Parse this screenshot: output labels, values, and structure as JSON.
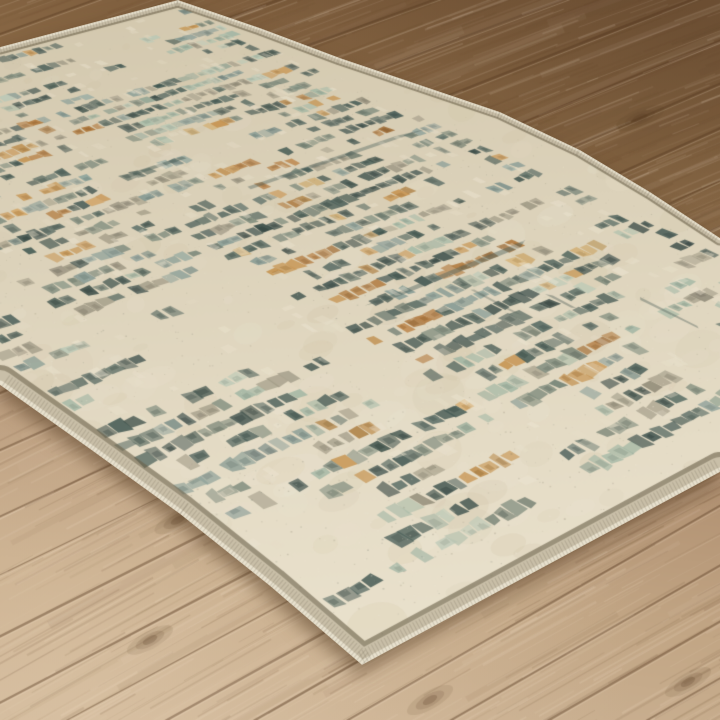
{
  "scene": {
    "subject": "Beige multicolor abstract area rug with dark slate, sage green and amber dashed plaid pattern, displayed at an angle on a brown wood plank floor",
    "width": 720,
    "height": 720
  },
  "floor": {
    "gradient": [
      "#7a5a3b",
      "#8d6c48",
      "#9f7e59",
      "#b19172",
      "#c2a685",
      "#cdb496"
    ],
    "seam_color": "rgba(86,58,34,0.42)",
    "seam_highlight": "rgba(255,240,220,0.20)",
    "plank_spacing": 58,
    "grain_light": "#ffeeda",
    "grain_dark": "#5e4026",
    "knot_color": "rgba(82,56,34,",
    "knots": [
      [
        150,
        640
      ],
      [
        430,
        700
      ],
      [
        688,
        682
      ],
      [
        640,
        118
      ],
      [
        72,
        300
      ],
      [
        178,
        520
      ],
      [
        560,
        420
      ]
    ]
  },
  "rug": {
    "polygon": [
      [
        0,
        385
      ],
      [
        0,
        47
      ],
      [
        178,
        0
      ],
      [
        260,
        28
      ],
      [
        340,
        58
      ],
      [
        420,
        85
      ],
      [
        500,
        112
      ],
      [
        580,
        150
      ],
      [
        650,
        192
      ],
      [
        720,
        238
      ],
      [
        720,
        472
      ],
      [
        362,
        665
      ],
      [
        270,
        586
      ],
      [
        180,
        514
      ],
      [
        90,
        449
      ]
    ],
    "near_edge": [
      [
        720,
        472
      ],
      [
        362,
        665
      ],
      [
        270,
        586
      ],
      [
        180,
        514
      ],
      [
        90,
        449
      ],
      [
        0,
        385
      ]
    ],
    "far_edge": [
      [
        0,
        47
      ],
      [
        178,
        0
      ],
      [
        260,
        28
      ],
      [
        340,
        58
      ],
      [
        420,
        85
      ],
      [
        500,
        112
      ],
      [
        580,
        150
      ],
      [
        650,
        192
      ],
      [
        720,
        238
      ]
    ],
    "corners": {
      "left": [
        -326,
        133
      ],
      "top": [
        178,
        0
      ],
      "near": [
        362,
        665
      ],
      "right": [
        939,
        347
      ]
    },
    "base_colors": [
      "#d3c8ae",
      "#dcd2ba",
      "#e5dcc6",
      "#ebe3cf"
    ],
    "cream": "#e6ddc8",
    "palette": {
      "dark_slate": "#3d544f",
      "deep_slate": "#2e4441",
      "gray_green": "#6e7e71",
      "taupe": "#9a9480",
      "sage": "#9eb4a2",
      "pale_sage": "#b6c7b5",
      "steel": "#7e9590",
      "amber": "#c2893f",
      "rust": "#aa6c2b",
      "gold": "#c8a05e"
    },
    "binding": {
      "tan": "#c9bfa8",
      "dark": "rgba(105,95,72,0.6)",
      "highlight": "rgba(236,229,211,0.9)",
      "tick": "rgba(111,100,80,0.22)"
    },
    "grid": {
      "cols": 56,
      "rows": 44
    },
    "pattern": {
      "presence_threshold": 0.68
    },
    "shadow": "drop-shadow(-4px 8px 9px rgba(70,45,22,0.5))"
  }
}
